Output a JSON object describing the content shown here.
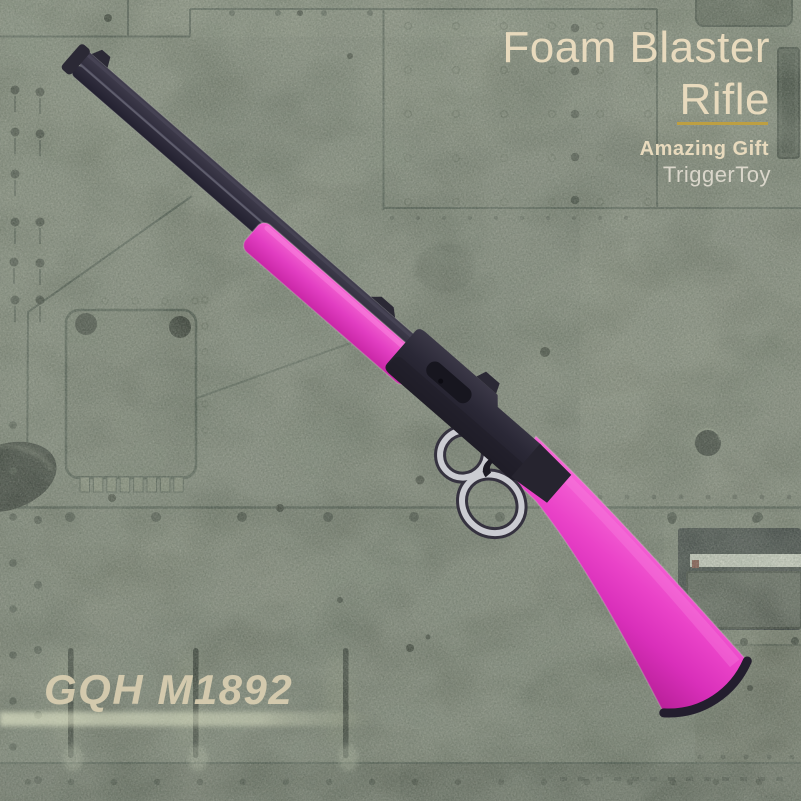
{
  "product": {
    "title_line1": "Foam Blaster",
    "title_line2": "Rifle",
    "tagline": "Amazing Gift",
    "brand": "TriggerToy",
    "model": "GQH M1892"
  },
  "style": {
    "accent_pink": "#e83fc4",
    "text_cream": "#e8dabd",
    "underline_gold": "#bd9f42",
    "metal_green": "#6d7366",
    "gun_black": "#2b2935",
    "lever_silver": "#cbccd2"
  }
}
